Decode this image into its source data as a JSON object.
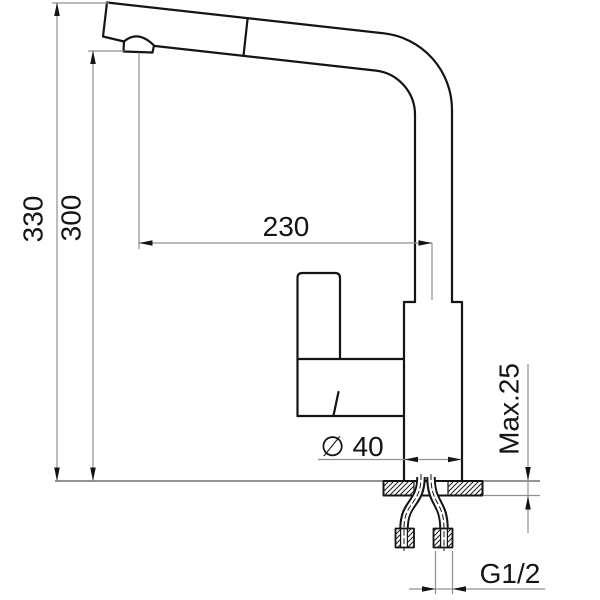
{
  "drawing": {
    "background_color": "#ffffff",
    "outline_color": "#141414",
    "dimension_line_color": "#8f8f8f",
    "dimensions": {
      "total_height": "330",
      "height_to_spout": "300",
      "spout_reach": "230",
      "base_diameter": "∅ 40",
      "max_mounting_thickness": "Max.25",
      "connection_thread": "G1/2"
    }
  }
}
